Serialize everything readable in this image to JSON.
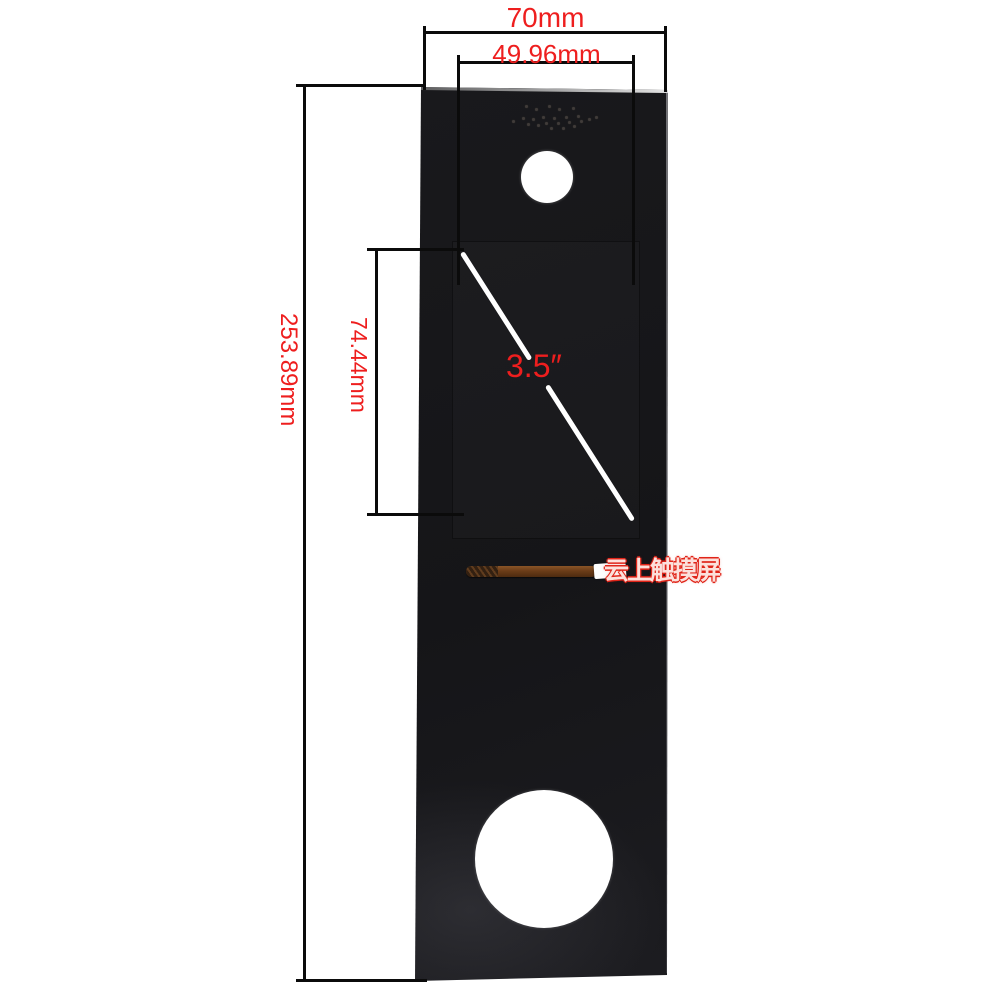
{
  "colors": {
    "annotation_red": "#ee1e1e",
    "dimension_line": "#0b0b0b",
    "panel_black": "#17171a",
    "diagonal_white": "#ffffff",
    "watermark_red": "#e02418"
  },
  "dimensions": {
    "overall_width": "70mm",
    "active_area_width": "49.96mm",
    "overall_height": "253.89mm",
    "active_area_height": "74.44mm",
    "display_diagonal": "3.5″"
  },
  "watermark": {
    "text": "云上触摸屏"
  },
  "panel": {
    "speaker_dots": [
      [
        512,
        120
      ],
      [
        522,
        117
      ],
      [
        527,
        123
      ],
      [
        532,
        118
      ],
      [
        537,
        124
      ],
      [
        542,
        116
      ],
      [
        545,
        122
      ],
      [
        550,
        127
      ],
      [
        553,
        117
      ],
      [
        557,
        122
      ],
      [
        562,
        127
      ],
      [
        565,
        116
      ],
      [
        568,
        121
      ],
      [
        573,
        125
      ],
      [
        577,
        115
      ],
      [
        580,
        120
      ],
      [
        588,
        118
      ],
      [
        595,
        116
      ],
      [
        525,
        105
      ],
      [
        535,
        108
      ],
      [
        548,
        105
      ],
      [
        558,
        108
      ],
      [
        572,
        107
      ]
    ]
  }
}
